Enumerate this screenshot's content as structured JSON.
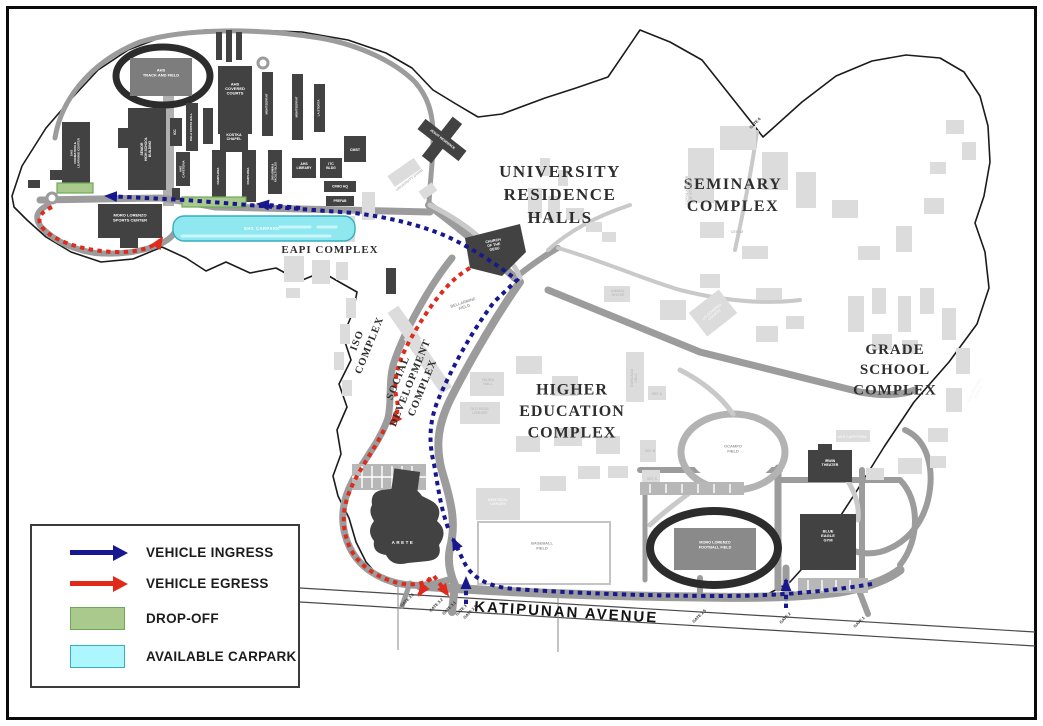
{
  "colors": {
    "ingress": "#17178f",
    "egress": "#df2a1c",
    "dropoff_fill": "#a9c98d",
    "dropoff_border": "#6fa85a",
    "carpark_fill": "#8fe7f0",
    "carpark_border": "#35aebe",
    "legend_carpark_fill": "#adf6fd",
    "dark_building": "#424242",
    "road_gray": "#9c9c9c"
  },
  "legend": {
    "items": [
      {
        "label": "VEHICLE INGRESS",
        "swatch": "arrow-blue"
      },
      {
        "label": "VEHICLE EGRESS",
        "swatch": "arrow-red"
      },
      {
        "label": "DROP-OFF",
        "swatch": "green-box"
      },
      {
        "label": "AVAILABLE CARPARK",
        "swatch": "cyan-box"
      }
    ]
  },
  "map": {
    "labels": {
      "regions": [
        {
          "id": "label-university-residence-halls",
          "lines": [
            "UNIVERSITY",
            "RESIDENCE",
            "HALLS"
          ],
          "x": 560,
          "y": 200,
          "s": 17,
          "c": "serif",
          "ls": 1.5,
          "lh": 1.35
        },
        {
          "id": "label-seminary-complex",
          "lines": [
            "SEMINARY",
            "COMPLEX"
          ],
          "x": 733,
          "y": 200,
          "s": 16,
          "c": "serif",
          "ls": 1.5,
          "lh": 1.35
        },
        {
          "id": "label-grade-school-complex",
          "lines": [
            "GRADE",
            "SCHOOL",
            "COMPLEX"
          ],
          "x": 895,
          "y": 374,
          "s": 15,
          "c": "serif",
          "ls": 1,
          "lh": 1.35
        },
        {
          "id": "label-higher-education-complex",
          "lines": [
            "HIGHER",
            "EDUCATION",
            "COMPLEX"
          ],
          "x": 572,
          "y": 416,
          "s": 16,
          "c": "serif",
          "ls": 1,
          "lh": 1.35
        },
        {
          "id": "label-eapi-complex",
          "lines": [
            "EAPI COMPLEX"
          ],
          "x": 330,
          "y": 253,
          "s": 11,
          "c": "serif",
          "ls": 1
        },
        {
          "id": "label-iso-complex",
          "lines": [
            "ISO",
            "COMPLEX"
          ],
          "x": 366,
          "y": 344,
          "s": 10.5,
          "c": "serif",
          "r": -68,
          "ls": 1,
          "lh": 1.25
        },
        {
          "id": "label-social-development-complex",
          "lines": [
            "SOCIAL",
            "DEVELOPMENT",
            "COMPLEX"
          ],
          "x": 413,
          "y": 384,
          "s": 10.5,
          "c": "serif",
          "r": -68,
          "ls": 1,
          "lh": 1.25
        }
      ],
      "roads": [
        {
          "id": "label-katipunan-avenue",
          "lines": [
            "KATIPUNAN AVENUE"
          ],
          "x": 566,
          "y": 617,
          "s": 15,
          "c": "kat",
          "r": 3.5,
          "ls": 2
        }
      ],
      "gates": [
        {
          "id": "label-gate-3-5",
          "lines": [
            "GATE 3.5"
          ],
          "x": 408,
          "y": 601,
          "s": 4,
          "c": "gate",
          "r": -45
        },
        {
          "id": "label-gate-3-2",
          "lines": [
            "GATE 3.2"
          ],
          "x": 437,
          "y": 606,
          "s": 4,
          "c": "gate",
          "r": -45
        },
        {
          "id": "label-gate-3-1",
          "lines": [
            "GATE 3.1"
          ],
          "x": 450,
          "y": 609,
          "s": 4,
          "c": "gate",
          "r": -45
        },
        {
          "id": "label-gate-3",
          "lines": [
            "GATE 3"
          ],
          "x": 462,
          "y": 611,
          "s": 4,
          "c": "gate",
          "r": -45
        },
        {
          "id": "label-gate-2-8",
          "lines": [
            "GATE 2.8"
          ],
          "x": 471,
          "y": 613,
          "s": 4,
          "c": "gate",
          "r": -45
        },
        {
          "id": "label-gate-2-5",
          "lines": [
            "GATE 2.5"
          ],
          "x": 700,
          "y": 617,
          "s": 4,
          "c": "gate",
          "r": -45
        },
        {
          "id": "label-gate-2",
          "lines": [
            "GATE 2"
          ],
          "x": 786,
          "y": 619,
          "s": 4,
          "c": "gate",
          "r": -45
        },
        {
          "id": "label-gate-1",
          "lines": [
            "GATE 1"
          ],
          "x": 860,
          "y": 623,
          "s": 4,
          "c": "gate",
          "r": -45
        },
        {
          "id": "label-gate-6",
          "lines": [
            "GATE 6"
          ],
          "x": 756,
          "y": 124,
          "s": 4,
          "c": "gate",
          "r": -45
        }
      ],
      "dark": [
        {
          "id": "label-ahs-track",
          "lines": [
            "AHS",
            "TRACK AND FIELD"
          ],
          "x": 161,
          "y": 74,
          "s": 4,
          "c": "white",
          "lh": 1.3
        },
        {
          "id": "label-ahs-covered-courts",
          "lines": [
            "AHS",
            "COVERED",
            "COURTS"
          ],
          "x": 235,
          "y": 90,
          "s": 4,
          "c": "white"
        },
        {
          "id": "label-shs-formation",
          "lines": [
            "SHS",
            "FORMATION &",
            "LEARNING CENTER"
          ],
          "x": 76,
          "y": 153,
          "s": 3.1,
          "c": "white",
          "r": -90
        },
        {
          "id": "label-senior-high-school",
          "lines": [
            "SENIOR",
            "HIGH SCHOOL",
            "BUILDING"
          ],
          "x": 147,
          "y": 149,
          "s": 3.4,
          "c": "white",
          "r": -90
        },
        {
          "id": "label-moro-lorenzo-sports-center",
          "lines": [
            "MORO LORENZO",
            "SPORTS CENTER"
          ],
          "x": 130,
          "y": 219,
          "s": 4,
          "c": "white",
          "lh": 1.3
        },
        {
          "id": "label-icc",
          "lines": [
            "ICC"
          ],
          "x": 176,
          "y": 132,
          "s": 3.2,
          "c": "white",
          "r": -90
        },
        {
          "id": "label-dela-costa-hall",
          "lines": [
            "DELA COSTA HALL"
          ],
          "x": 192,
          "y": 127,
          "s": 3,
          "c": "white",
          "r": -90
        },
        {
          "id": "label-kostka-chapel",
          "lines": [
            "KOSTKA",
            "CHAPEL"
          ],
          "x": 234,
          "y": 138,
          "s": 3.6,
          "c": "white"
        },
        {
          "id": "label-montserrat-1",
          "lines": [
            "MONTSERRAT"
          ],
          "x": 267.5,
          "y": 104,
          "s": 3,
          "c": "white",
          "r": -90
        },
        {
          "id": "label-montserrat-2",
          "lines": [
            "MONTSERRAT"
          ],
          "x": 297.5,
          "y": 107,
          "s": 3,
          "c": "white",
          "r": -90
        },
        {
          "id": "label-la-storta",
          "lines": [
            "LA STORTA"
          ],
          "x": 319.5,
          "y": 108,
          "s": 3,
          "c": "white",
          "r": -90
        },
        {
          "id": "label-ahs-cafeteria",
          "lines": [
            "AHS",
            "CAFETERIA"
          ],
          "x": 183,
          "y": 169,
          "s": 3,
          "c": "white",
          "r": -90
        },
        {
          "id": "label-pamplona-1",
          "lines": [
            "PAMPLONA"
          ],
          "x": 219,
          "y": 176,
          "s": 3,
          "c": "white",
          "r": -90
        },
        {
          "id": "label-pamplona-2",
          "lines": [
            "PAMPLONA"
          ],
          "x": 249,
          "y": 176,
          "s": 3,
          "c": "white",
          "r": -90
        },
        {
          "id": "label-jhs-admin",
          "lines": [
            "JHS ADMIN &",
            "FACULTY BLDG"
          ],
          "x": 275,
          "y": 172,
          "s": 2.6,
          "c": "white",
          "r": -90
        },
        {
          "id": "label-ahs-library",
          "lines": [
            "AHS",
            "LIBRARY"
          ],
          "x": 304,
          "y": 167,
          "s": 3.4,
          "c": "white"
        },
        {
          "id": "label-itc-bldg",
          "lines": [
            "ITC",
            "BLDG"
          ],
          "x": 331,
          "y": 167,
          "s": 3.4,
          "c": "white"
        },
        {
          "id": "label-cmst",
          "lines": [
            "CMST"
          ],
          "x": 355,
          "y": 151,
          "s": 3.6,
          "c": "white"
        },
        {
          "id": "label-cfmo-hq",
          "lines": [
            "CFMO HQ"
          ],
          "x": 340,
          "y": 187.5,
          "s": 3.4,
          "c": "white"
        },
        {
          "id": "label-prefab",
          "lines": [
            "PREFAB"
          ],
          "x": 340,
          "y": 202,
          "s": 3.2,
          "c": "white"
        },
        {
          "id": "label-church-of-the-gesu",
          "lines": [
            "CHURCH",
            "OF THE",
            "GESU"
          ],
          "x": 494,
          "y": 246,
          "s": 3.6,
          "c": "white",
          "r": -10
        },
        {
          "id": "label-jesuit-residence",
          "lines": [
            "JESUIT RESIDENCE"
          ],
          "x": 442,
          "y": 140,
          "s": 3.2,
          "c": "white",
          "r": 38
        },
        {
          "id": "label-irwin-theater",
          "lines": [
            "IRWIN",
            "THEATER"
          ],
          "x": 830,
          "y": 464,
          "s": 3.6,
          "c": "white"
        },
        {
          "id": "label-blue-eagle-gym",
          "lines": [
            "BLUE",
            "EAGLE",
            "GYM"
          ],
          "x": 828,
          "y": 537,
          "s": 4,
          "c": "white"
        },
        {
          "id": "label-moro-lorenzo-football-field",
          "lines": [
            "MORO LORENZO",
            "FOOTBALL FIELD"
          ],
          "x": 715,
          "y": 546,
          "s": 3.8,
          "c": "white",
          "lh": 1.3
        },
        {
          "id": "label-arete",
          "lines": [
            "ARETE"
          ],
          "x": 403,
          "y": 544,
          "s": 4.5,
          "c": "white",
          "ls": 1.5
        },
        {
          "id": "label-shs-carpark",
          "lines": [
            "SHS CARPARK"
          ],
          "x": 262,
          "y": 230,
          "s": 4.2,
          "c": "white",
          "ls": 0.5
        }
      ],
      "fields": [
        {
          "id": "label-bellarmine-field",
          "lines": [
            "BELLARMINE",
            "FIELD"
          ],
          "x": 464,
          "y": 306,
          "s": 4,
          "c": "gray",
          "r": -18
        },
        {
          "id": "label-baseball-field",
          "lines": [
            "BASEBALL",
            "FIELD"
          ],
          "x": 542,
          "y": 547,
          "s": 4,
          "c": "gray"
        },
        {
          "id": "label-ocampo-field",
          "lines": [
            "OCAMPO",
            "FIELD"
          ],
          "x": 733,
          "y": 450,
          "s": 4,
          "c": "gray"
        }
      ],
      "faint": [
        {
          "id": "label-university-dorm",
          "lines": [
            "UNIVERSITY DORM"
          ],
          "x": 410,
          "y": 181,
          "s": 3.6,
          "c": "faint",
          "r": -38
        },
        {
          "id": "label-loyola-house-of-studies",
          "lines": [
            "LOYOLA HOUSE",
            "OF STUDIES"
          ],
          "x": 690,
          "y": 190,
          "s": 3.6,
          "c": "faint",
          "r": -90
        },
        {
          "id": "label-cefam",
          "lines": [
            "CEFAM"
          ],
          "x": 737,
          "y": 233,
          "s": 3.6,
          "c": "faint"
        },
        {
          "id": "label-animal-house",
          "lines": [
            "ANIMAL",
            "HOUSE"
          ],
          "x": 618,
          "y": 294,
          "s": 3.6,
          "c": "faint"
        },
        {
          "id": "label-faura-hall",
          "lines": [
            "FAURA",
            "HALL"
          ],
          "x": 488,
          "y": 383,
          "s": 3.6,
          "c": "faint"
        },
        {
          "id": "label-old-rizal-library",
          "lines": [
            "OLD RIZAL",
            "LIBRARY"
          ],
          "x": 480,
          "y": 412,
          "s": 3.6,
          "c": "faint"
        },
        {
          "id": "label-gonzaga-hall",
          "lines": [
            "GONZAGA",
            "HALL"
          ],
          "x": 635,
          "y": 378,
          "s": 3.6,
          "c": "faint",
          "r": -90
        },
        {
          "id": "label-new-rizal-library",
          "lines": [
            "NEW RIZAL",
            "LIBRARY"
          ],
          "x": 498,
          "y": 503,
          "s": 3.6,
          "c": "fwhite"
        },
        {
          "id": "label-ls-covered-courts",
          "lines": [
            "LS COVERED",
            "COURTS"
          ],
          "x": 714,
          "y": 314,
          "s": 3.6,
          "c": "fwhite",
          "r": -40
        },
        {
          "id": "label-ags-cafeteria",
          "lines": [
            "AGS CAFETERIA"
          ],
          "x": 852,
          "y": 438,
          "s": 3.6,
          "c": "fwhite"
        },
        {
          "id": "label-ags-covered-courts",
          "lines": [
            "AGS COVERED",
            "COURTS"
          ],
          "x": 977,
          "y": 392,
          "s": 3.6,
          "c": "fwhite",
          "r": -62
        },
        {
          "id": "label-sec-a",
          "lines": [
            "SEC A"
          ],
          "x": 657,
          "y": 395,
          "s": 3.4,
          "c": "faint"
        },
        {
          "id": "label-sec-b",
          "lines": [
            "SEC B"
          ],
          "x": 650,
          "y": 452,
          "s": 3.4,
          "c": "faint"
        },
        {
          "id": "label-sec-c",
          "lines": [
            "SEC C"
          ],
          "x": 652,
          "y": 480,
          "s": 3.4,
          "c": "faint"
        }
      ]
    }
  }
}
